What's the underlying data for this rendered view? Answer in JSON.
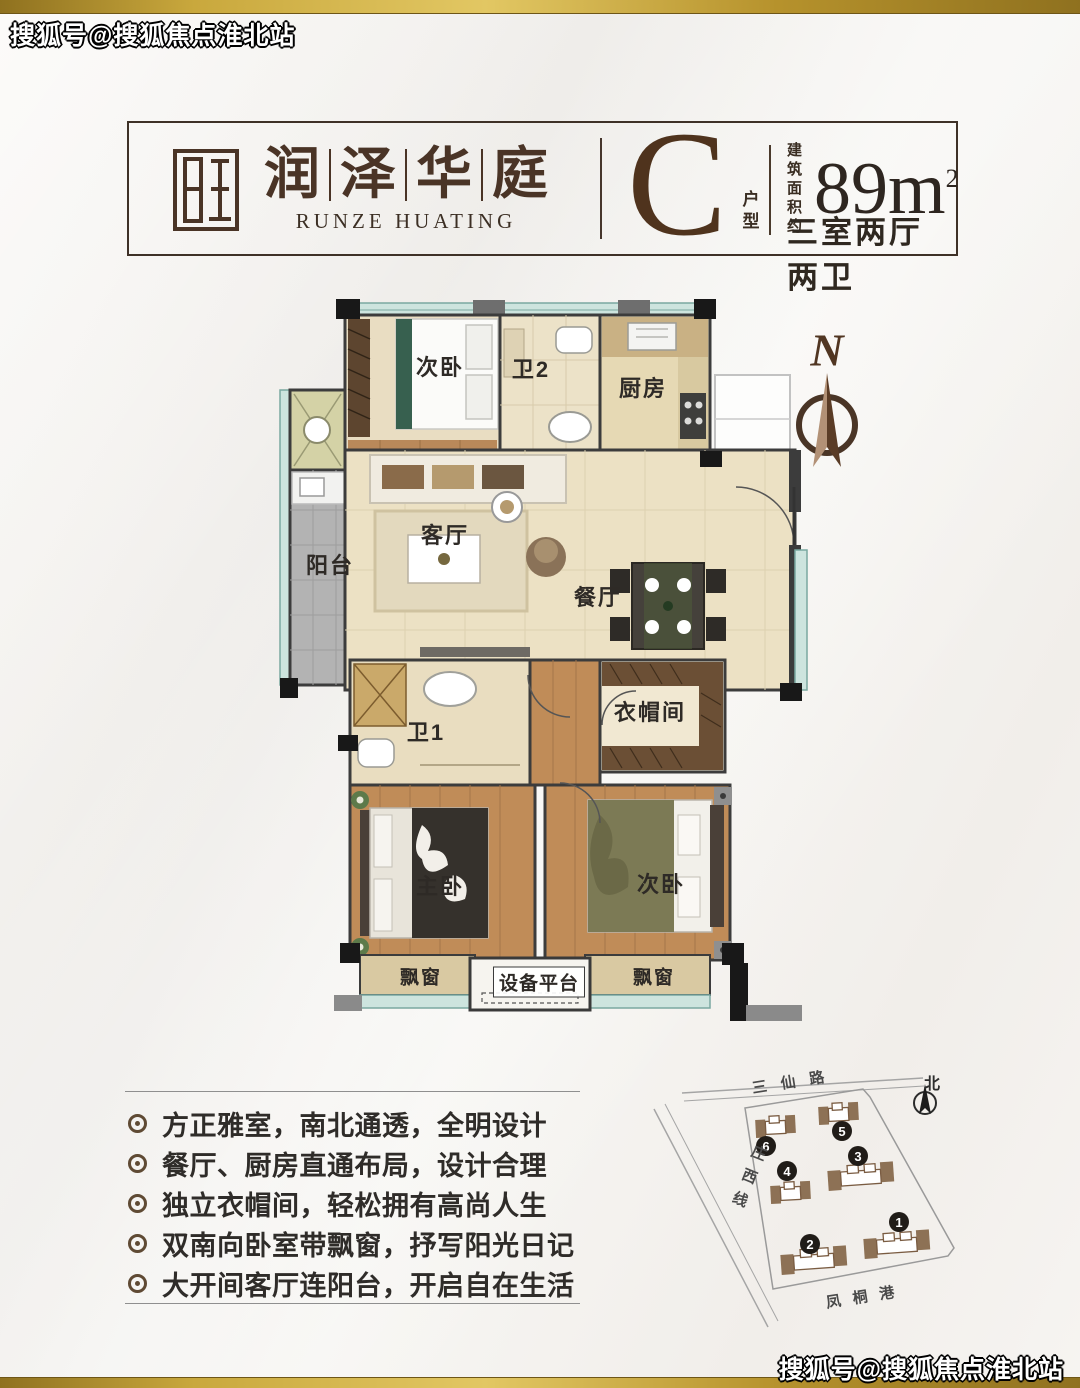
{
  "watermark": {
    "top_left": "搜狐号@搜狐焦点淮北站",
    "bottom_right": "搜狐号@搜狐焦点淮北站"
  },
  "header": {
    "brand_chars": [
      "润",
      "泽",
      "华",
      "庭"
    ],
    "brand_en": "RUNZE HUATING",
    "unit_letter": "C",
    "unit_type_vertical": "户型",
    "area_label_line1": "建 筑",
    "area_label_line2": "面积约",
    "area_value": "89m",
    "area_sup": "2",
    "rooms_summary": "三室两厅两卫"
  },
  "floorplan": {
    "compass": "N",
    "rooms": {
      "bedroom_top": "次卧",
      "bath2": "卫2",
      "kitchen": "厨房",
      "balcony": "阳台",
      "living": "客厅",
      "dining": "餐厅",
      "bath1": "卫1",
      "cloakroom": "衣帽间",
      "master": "主卧",
      "bedroom_bottom": "次卧",
      "bay_window_left": "飘窗",
      "equipment": "设备平台",
      "bay_window_right": "飘窗"
    }
  },
  "features": {
    "items": [
      "方正雅室，南北通透，全明设计",
      "餐厅、厨房直通布局，设计合理",
      "独立衣帽间，轻松拥有高尚人生",
      "双南向卧室带飘窗，抒写阳光日记",
      "大开间客厅连阳台，开启自在生活"
    ]
  },
  "siteplan": {
    "road_top": "三仙路",
    "road_left": "庄西线",
    "road_bottom": "凤桐港",
    "north_label": "北",
    "buildings": [
      "1",
      "2",
      "3",
      "4",
      "5",
      "6"
    ]
  },
  "colors": {
    "gold_accent": "#c9a83d",
    "brand_brown": "#4a3426",
    "wall_dark": "#3c3c3c",
    "window_teal": "#cde4de",
    "floor_beige": "#ece1c4",
    "floor_wood": "#c08c58"
  }
}
